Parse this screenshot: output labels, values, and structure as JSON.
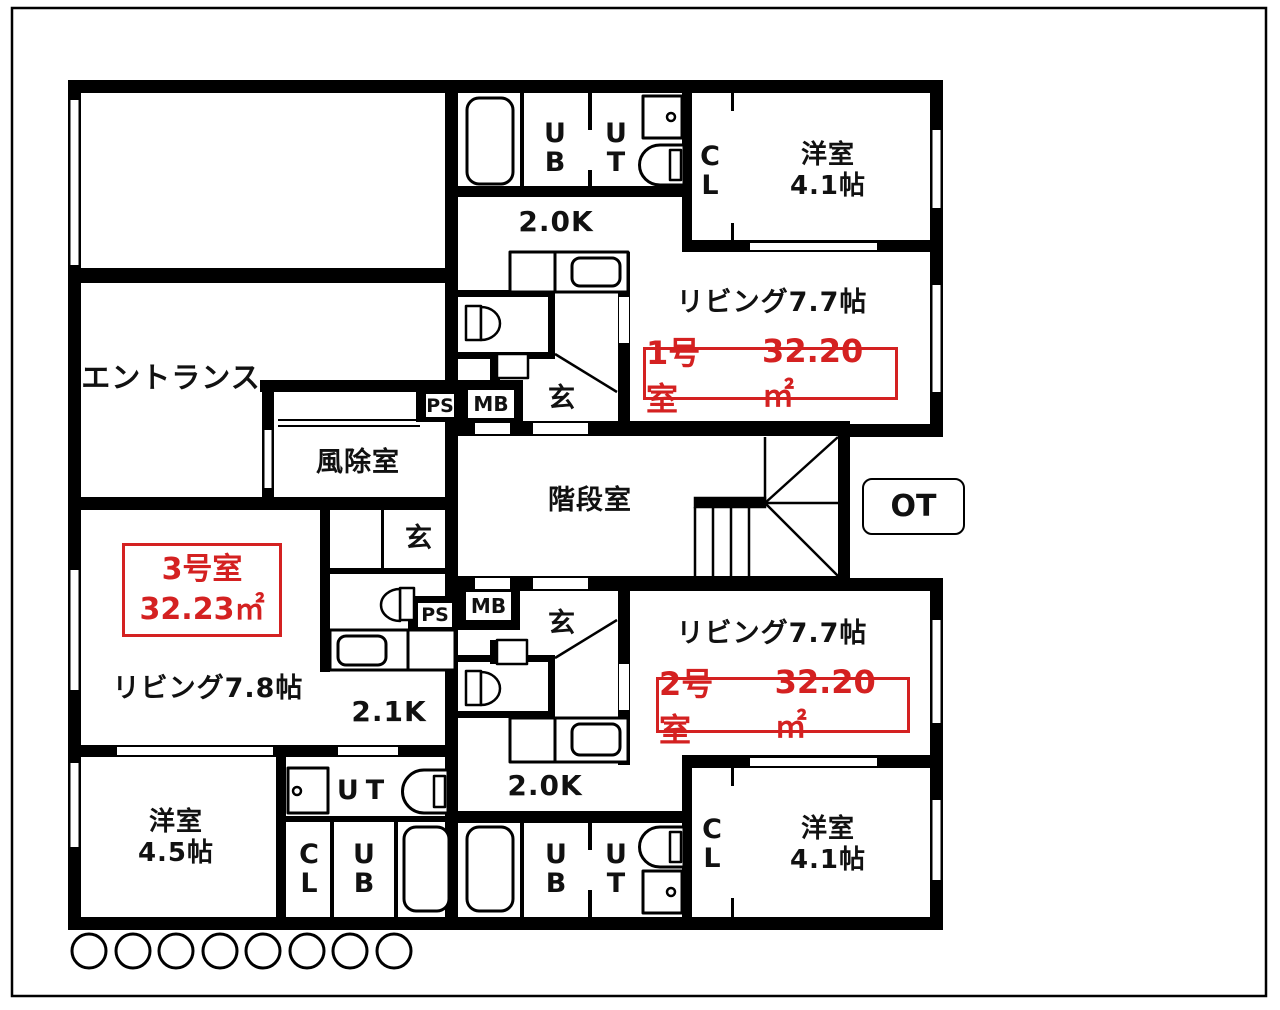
{
  "palette": {
    "wall": "#000000",
    "background": "#ffffff",
    "accent_red": "#d42121"
  },
  "common": {
    "entrance": "エントランス",
    "windbreak": "風除室",
    "stairwell": "階段室",
    "ot": "OT",
    "ps": "PS",
    "mb": "MB",
    "genkan": "玄"
  },
  "units": {
    "u1": {
      "name": "1号室",
      "area": "32.20㎡",
      "living": "リビング7.7帖",
      "kitchen": "2.0K",
      "bedroom": "洋室\n4.1帖",
      "ub": "UB",
      "ut": "UT",
      "cl": "CL"
    },
    "u2": {
      "name": "2号室",
      "area": "32.20㎡",
      "living": "リビング7.7帖",
      "kitchen": "2.0K",
      "bedroom": "洋室\n4.1帖",
      "ub": "UB",
      "ut": "UT",
      "cl": "CL"
    },
    "u3": {
      "name": "3号室",
      "area": "32.23㎡",
      "living": "リビング7.8帖",
      "kitchen": "2.1K",
      "bedroom": "洋室\n4.5帖",
      "ub": "UB",
      "ut": "UT",
      "cl": "CL"
    }
  }
}
